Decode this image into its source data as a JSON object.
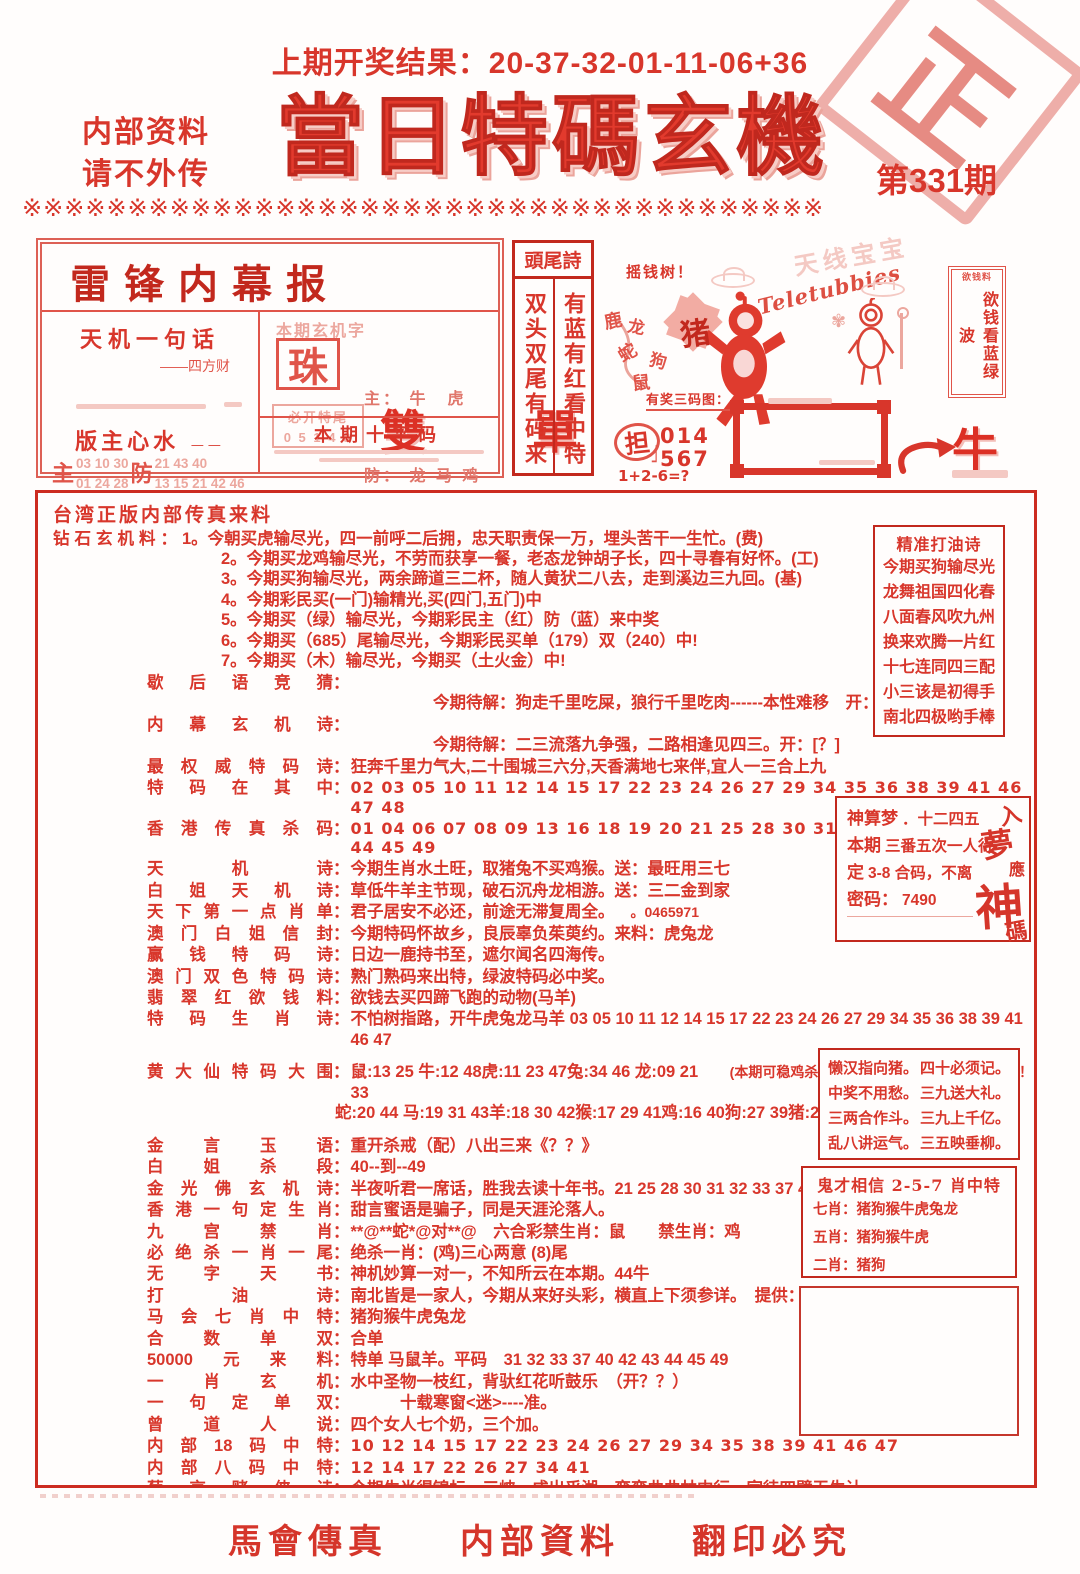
{
  "header": {
    "prev_result": "上期开奖结果：20-37-32-01-11-06+36",
    "note1": "内部资料",
    "note2": "请不外传",
    "title": "當日特碼玄機",
    "issue": "第331期",
    "stamp": "正"
  },
  "divider": "※※※※※※※※※※※※※※※※※※※※※※※※※※※※※※※※※※※※※※",
  "leifeng": {
    "title": "雷锋内幕报",
    "tianji_label": "天机一句话",
    "tianji_sub": "——四方财",
    "banzhu_label": "版主心水",
    "banzhu_sub": "——",
    "zhu_char": "主",
    "zhu_line1": "03 10 30",
    "zhu_line2": "01 24 28",
    "fang_char": "防",
    "fang_line1": "21 43 40",
    "fang_line2": "13 15 21 42 46",
    "xuanji_label": "本期玄机字",
    "xuanji_char": "珠",
    "sheng_line1": "主： 牛　虎",
    "sheng_line2": "防： 龙 马 鸡",
    "bikai_label": "必开特尾",
    "bikai_nums": "0 5 1 4 8",
    "shuangdan": "雙　單",
    "shiping_title": "本期十平码"
  },
  "touwei": {
    "title": "頭尾詩",
    "col_left": "双头双尾有码来",
    "col_right": "有蓝有红看中特"
  },
  "tele": {
    "faint_name": "天线宝宝",
    "logo": "Teletubbies",
    "yaoqianshu": "摇钱树！",
    "animals": [
      "鹿",
      "龙",
      "蛇",
      "猪",
      "狗",
      "鼠"
    ],
    "caption": "有奖三码图：",
    "dan_char": "担",
    "dan_num1": "014",
    "dan_num2": "567",
    "formula": "1+2-6=?",
    "scroll_top": "欲钱料",
    "scroll_text": "欲钱看蓝绿波",
    "ox_char": "牛"
  },
  "main": {
    "rows": [
      {
        "cls": "flush intro",
        "text": "台湾正版内部传真来料"
      },
      {
        "cls": "flush",
        "label_plain": "钻石玄机料：",
        "items": [
          "1。今朝买虎输尽光，四一前呼二后拥，忠天职责保一万，埋头苦干一生忙。(费)",
          "2。今期买龙鸡输尽光，不劳而获享一餐，老态龙钟胡子长，四十寻春有好怀。(工)",
          "3。今期买狗输尽光，两余蹄道三二杯，随人黄犾二八去，走到溪边三九回。(基)",
          "4。今期彩民买(一门)输精光,买(四门,五门)中",
          "5。今期买（绿）输尽光，今期彩民主（红）防（蓝）来中奖",
          "6。今期买（685）尾输尽光，今期彩民买单（179）双（240）中!",
          "7。今期买（木）输尽光，今期买（土火金）中!"
        ]
      },
      {
        "label": "歇后语竞猜",
        "sub": "今期待解：狗走千里吃屎，狼行千里吃肉------本性难移　开：[？]"
      },
      {
        "label": "内幕玄机诗",
        "sub": "今期待解：二三流落九争强，二路相逢见四三。开：[？]"
      },
      {
        "label": "最权威特码诗",
        "text": "狂奔千里力气大,二十围城三六分,天香满地七来伴,宜人一三合上九"
      },
      {
        "cls": "nums",
        "label": "特码在其中",
        "text": "02 03 05 10 11 12 14 15 17 22 23 24 26 27 29 34 35 36 38 39 41 46 47 48"
      },
      {
        "cls": "nums",
        "label": "香港传真杀码",
        "text": "01 04 06 07 08 09 13 16 18 19 20 21 25 28 30 31 32 33 37 40 42 43 44 45 49"
      },
      {
        "label": "天机诗",
        "text": "今期生肖水土旺，取猪兔不买鸡猴。送：最旺用三七"
      },
      {
        "label": "白姐天机诗",
        "text": "草低牛羊主节现，破石沉舟龙相游。送：三二金到家"
      },
      {
        "label": "天下第一点肖单",
        "text": "君子居安不必还，前途无滞复周全。",
        "note": "。0465971"
      },
      {
        "label": "澳门白姐信封",
        "text": "今期特码怀故乡，良辰辜负茱萸约。来料：虎兔龙"
      },
      {
        "label": "赢钱特码诗",
        "text": "日边一鹿持书至，遮尔闻名四海传。"
      },
      {
        "label": "澳门双色特码诗",
        "text": "熟门熟码来出特，绿波特码必中奖。"
      },
      {
        "label": "翡翠红欲钱料",
        "text": "欲钱去买四蹄飞跑的动物(马羊)"
      },
      {
        "label": "特码生肖诗",
        "text": "不怕树指路，开牛虎兔龙马羊 03 05 10 11 12 14 15 17 22 23 24 26 27 29 34 35 36 38 39 41 46 47"
      },
      {
        "cls": "gap",
        "label": "黄大仙特码大围",
        "text": "鼠:13 25 牛:12 48虎:11 23 47兔:34 46 龙:09 21 33",
        "note": "(本期可稳鸡杀肖)；注：只做参考！非会员料！！",
        "text2": "蛇:20 44 马:19 31 43羊:18 30 42猴:17 29 41鸡:16 40狗:27 39猪:26 38"
      },
      {
        "cls": "gap",
        "label": "金言玉语",
        "text": "重开杀戒（配）八出三来《？？》"
      },
      {
        "label": "白姐杀段",
        "text": "40--到--49"
      },
      {
        "label": "金光佛玄机诗",
        "text": "半夜听君一席话，胜我去读十年书。21 25 28 30 31 32 33 37 40 42 43 44"
      },
      {
        "label": "香港一句定生肖",
        "text": "甜言蜜语是骗子，同是天涯沦落人。"
      },
      {
        "label": "九宫禁肖",
        "text": "**@**蛇*@对**@　六合彩禁生肖：鼠　　禁生肖：鸡"
      },
      {
        "label": "必绝杀一肖一尾",
        "text": "绝杀一肖：(鸡)三心两意 (8)尾"
      },
      {
        "label": "无字天书",
        "text": "神机妙算一对一，不知所云在本期。44牛"
      },
      {
        "label": "打油诗",
        "text": "南北皆是一家人，今期从来好头彩，横直上下须参详。　提供：(猴牛虎兔龙)"
      },
      {
        "label": "马会七肖中特",
        "text": "猪狗猴牛虎兔龙"
      },
      {
        "label": "合数单双",
        "text": "合单"
      },
      {
        "label": "50000元来料",
        "text": "特单 马鼠羊。平码　31 32 33 37 40 42 43 44 45 49"
      },
      {
        "label": "一肖玄机",
        "text": "水中圣物一枝红，背驮红花听鼓乐　（开？？）"
      },
      {
        "label": "一句定单双",
        "text": "　　　十载寒窗<迷>----准。"
      },
      {
        "label": "曾道人说",
        "text": "四个女人七个奶，三个加。"
      },
      {
        "cls": "nums",
        "label": "内部18码中特",
        "text": "10 12 14 15 17 22 23 24 26 27 29 34 35 38 39 41 46 47"
      },
      {
        "cls": "nums",
        "label": "内部八码中特",
        "text": "12 14 17 22 26 27 34 41"
      },
      {
        "cls": "pj",
        "label": "葡京赌侠诗",
        "text": "今期生肖得锦标，三峡一成出乎湖，弯弯曲曲林中行，家徒四壁无生计。",
        "text2": "青井离乡当苦力，同气相求人指点，四面八方皆同道，三一苦求中特码。"
      },
      {
        "cls": "center",
        "text": "生活幽默：高朝镇"
      }
    ],
    "humor": [
      "有一镇名曰高朝镇，一大爷搭上了去往高朝镇的班车走亲戚，上车后一路不停的问人家女售票员：同志，高潮到了吗？答曰：没呢！",
      "过了一会，大爷又问：哎我说，这位女同志，到高潮了没？回答：还没呢！",
      "几分钟后，大爷嚷开了：同志，我都坐了这么久了，怎么还没到高潮啊？　售票员不耐烦了对大爷说：你喊她，你喊她，到了高潮了我自己不会叫的啊。真是的…．"
    ]
  },
  "dayou": {
    "title": "精准打油诗",
    "lines": [
      "今期买狗输尽光",
      "龙舞祖国四化春",
      "八面春风吹九州",
      "换来欢腾一片红",
      "十七连同四三配",
      "小三该是初得手",
      "南北四极哟手棒"
    ]
  },
  "shensuan": {
    "lines": [
      {
        "b": "神算梦",
        "t": "．十二四五"
      },
      {
        "b": "本期",
        "t": "三番五次一人行"
      },
      {
        "b": "定",
        "t": "3-8 合码，不离"
      },
      {
        "b": "密码：",
        "t": "7490"
      }
    ],
    "vertical": [
      "入",
      "夢",
      "應",
      "神",
      "碼"
    ]
  },
  "couplet": {
    "lines": [
      [
        "懒汉指向猪。",
        "四十必须记。"
      ],
      [
        "中奖不用愁。",
        "三九送大礼。"
      ],
      [
        "三两合作斗。",
        "三九上千亿。"
      ],
      [
        "乱八讲运气。",
        "三五映垂柳。"
      ]
    ]
  },
  "guicai": {
    "title": "鬼才相信 2-5-7 肖中特",
    "lines": [
      "七肖：猪狗猴牛虎兔龙",
      "五肖：猪狗猴牛虎",
      "二肖：猪狗"
    ]
  },
  "footer": {
    "item1": "馬會傳真",
    "item2": "内部資料",
    "item3": "翻印必究"
  }
}
